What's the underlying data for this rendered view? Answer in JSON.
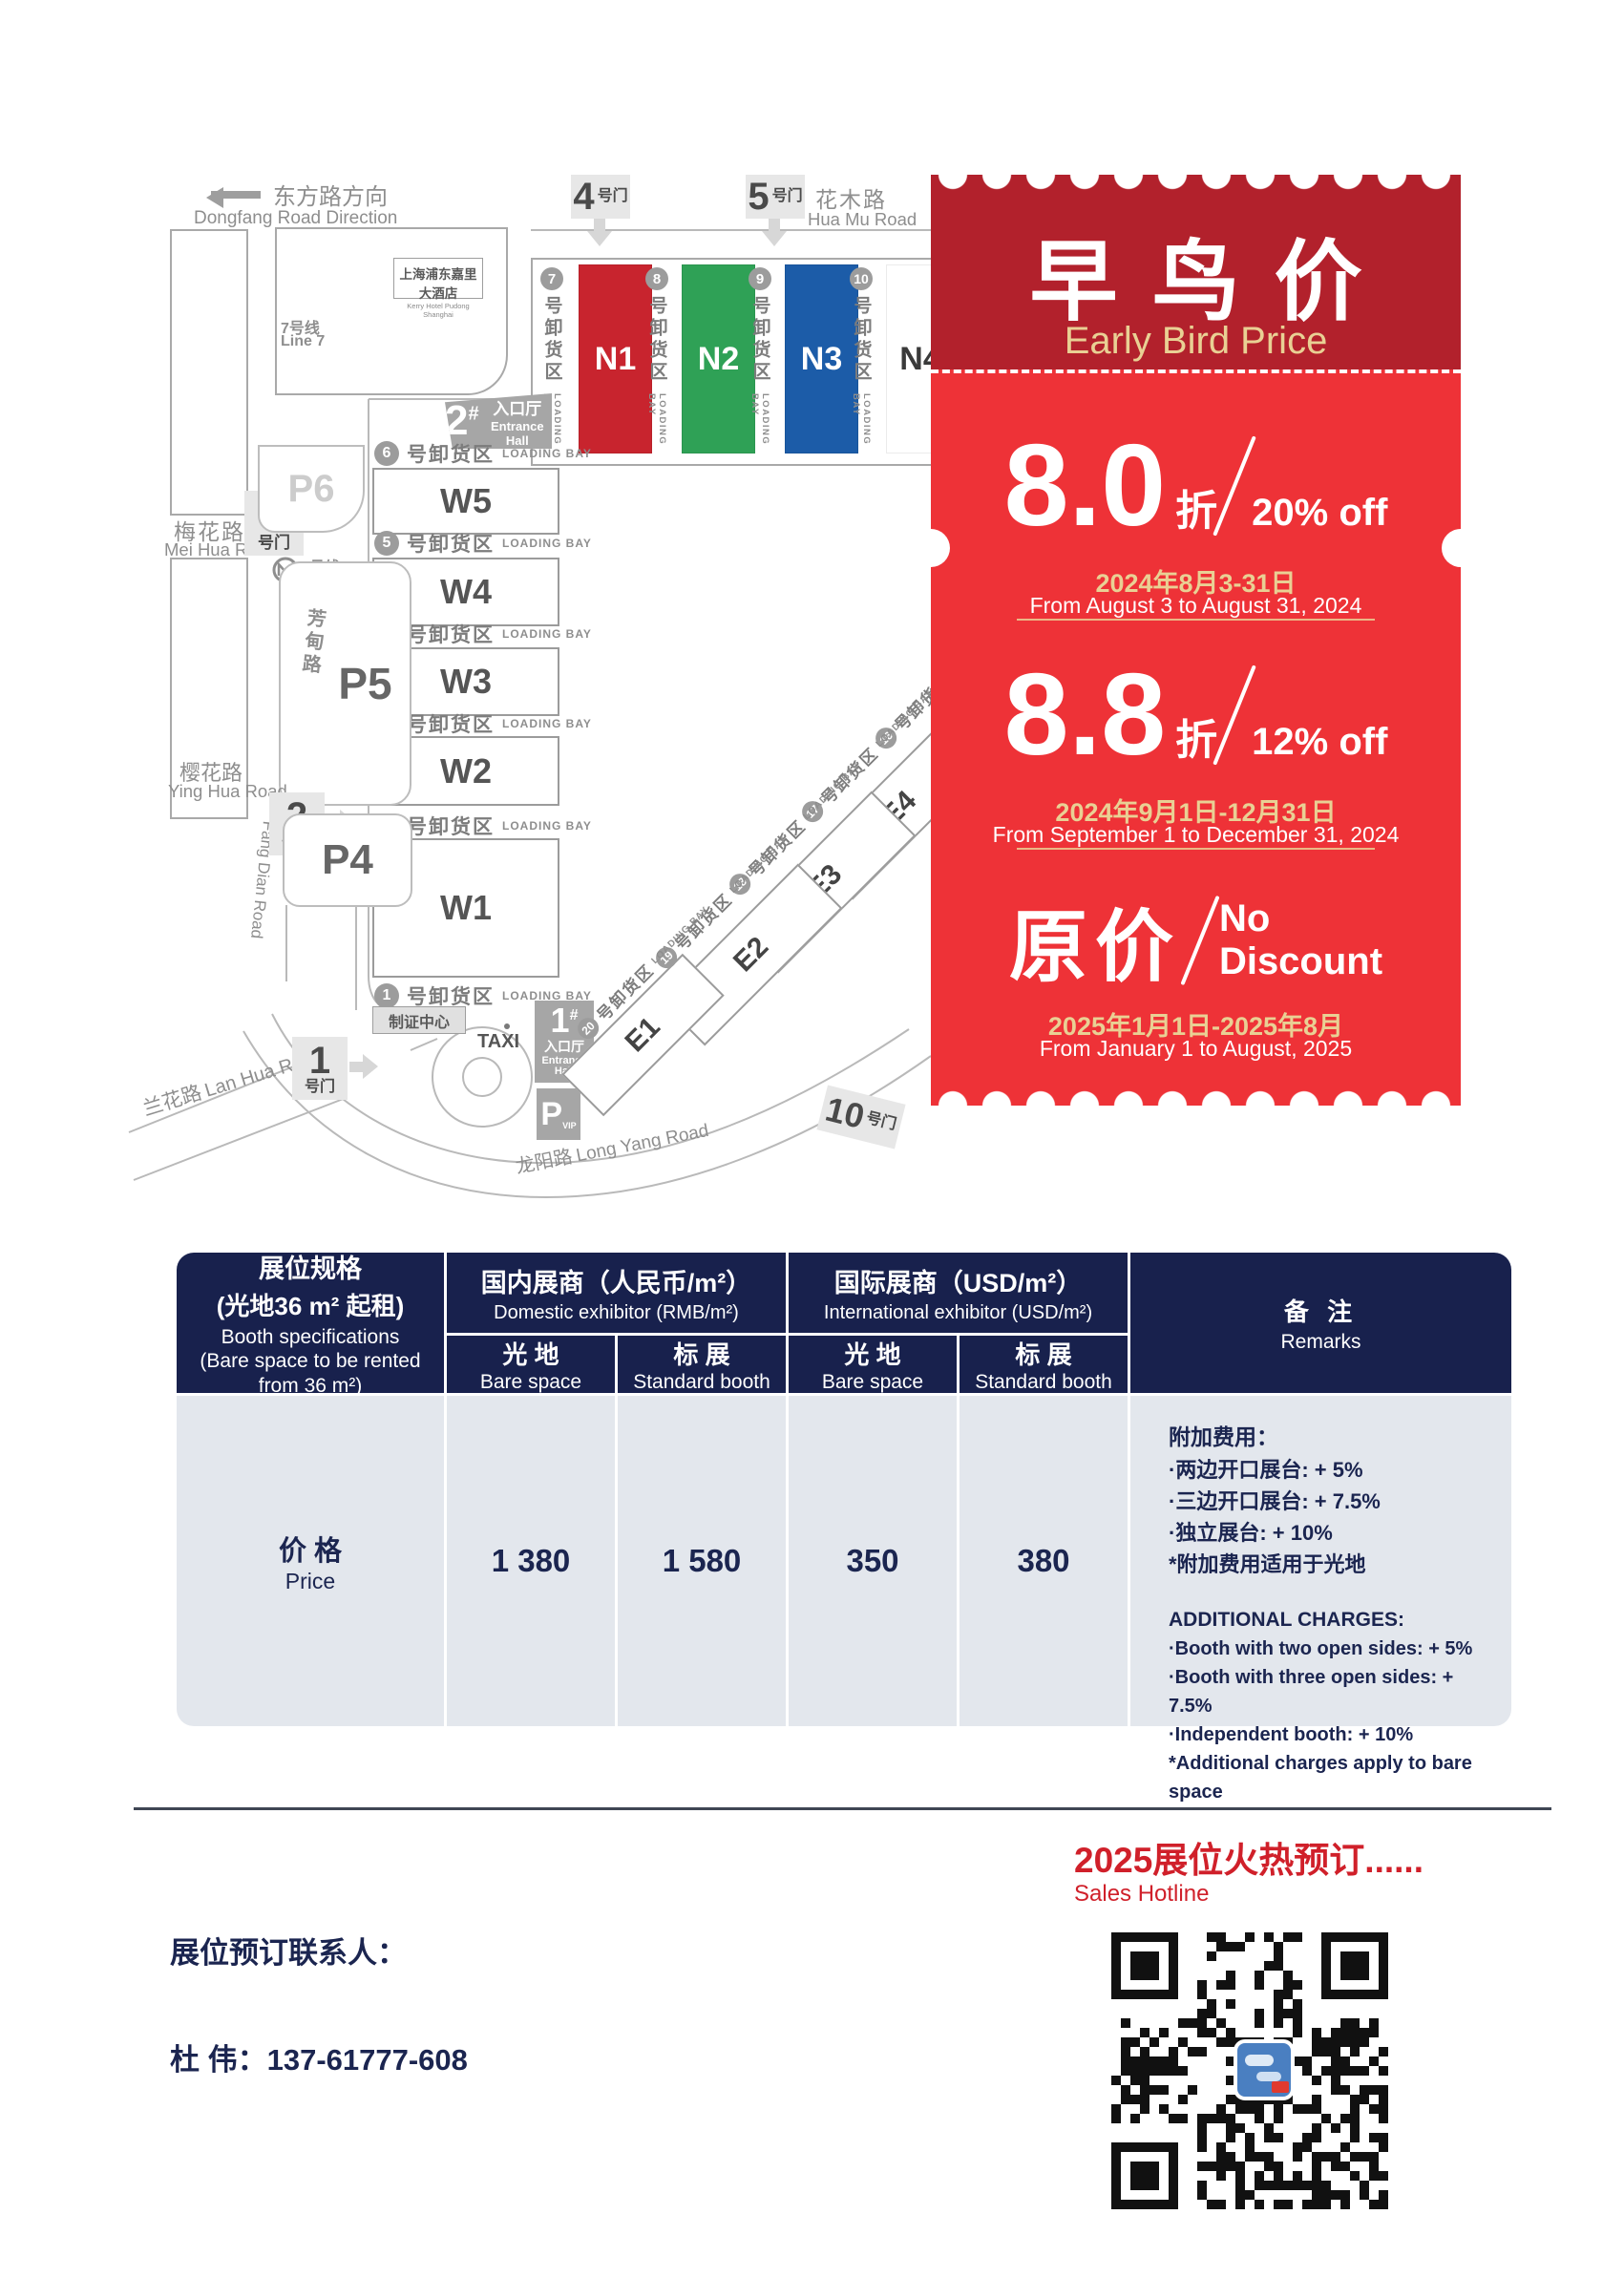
{
  "map": {
    "direction_zh": "东方路方向",
    "direction_en": "Dongfang Road Direction",
    "gate_suffix": "号门",
    "gate4_num": "4",
    "gate5_num": "5",
    "gate3_num": "3",
    "gate2_num": "2",
    "gate1_num": "1",
    "gate10_num": "10",
    "huamu_zh": "花木路",
    "huamu_en": "Hua Mu Road",
    "meihua_zh": "梅花路",
    "meihua_en": "Mei Hua Road",
    "yinghua_zh": "樱花路",
    "yinghua_en": "Ying Hua Road",
    "fangdian_zh": "芳甸路",
    "fangdian_en": "Fang Dian Road",
    "lanhua_zh": "兰花路",
    "lanhua_en": "Lan Hua Road",
    "longyang_zh": "龙阳路",
    "longyang_en": "Long Yang Road",
    "hotel_zh": "上海浦东嘉里大酒店",
    "hotel_en": "Kerry Hotel Pudong Shanghai",
    "metro_zh": "7号线",
    "metro_en": "Line 7",
    "p6": "P6",
    "p5": "P5",
    "p4": "P4",
    "pvip": "P",
    "pvip_sub": "VIP",
    "ent2_num": "2",
    "ent1_num": "1",
    "ent_hash": "#",
    "ent_zh": "入口厅",
    "ent_en": "Entrance Hall",
    "zhizheng": "制证中心",
    "taxi": "TAXI",
    "bay_zh": "号卸货区",
    "bay_en": "LOADING BAY",
    "bays_n": [
      "7",
      "8",
      "9",
      "10"
    ],
    "halls_n": [
      {
        "label": "N1",
        "color": "#c8242e",
        "text": "#ffffff"
      },
      {
        "label": "N2",
        "color": "#2fa156",
        "text": "#ffffff"
      },
      {
        "label": "N3",
        "color": "#1c5ca8",
        "text": "#ffffff"
      },
      {
        "label": "N4",
        "color": "#ffffff",
        "text": "#3a3a3a"
      }
    ],
    "halls_w": [
      "W5",
      "W4",
      "W3",
      "W2",
      "W1"
    ],
    "bays_w": [
      "6",
      "5",
      "4",
      "3",
      "2",
      "1"
    ],
    "halls_e": [
      "E4",
      "E3",
      "E2",
      "E1"
    ],
    "bays_e": [
      "16",
      "17",
      "18",
      "19",
      "20"
    ]
  },
  "promo": {
    "title_zh": "早鸟价",
    "title_en": "Early Bird Price",
    "tier1_rate": "8.0",
    "tier1_zhe": "折",
    "tier1_off": "20% off",
    "tier1_date_zh": "2024年8月3-31日",
    "tier1_date_en": "From August 3 to August 31, 2024",
    "tier2_rate": "8.8",
    "tier2_zhe": "折",
    "tier2_off": "12% off",
    "tier2_date_zh": "2024年9月1日-12月31日",
    "tier2_date_en": "From September 1 to December 31, 2024",
    "tier3_label": "原价",
    "tier3_off1": "No",
    "tier3_off2": "Discount",
    "tier3_date_zh": "2025年1月1日-2025年8月",
    "tier3_date_en": "From January 1 to August, 2025"
  },
  "table": {
    "spec_zh1": "展位规格",
    "spec_zh2": "(光地36 m² 起租)",
    "spec_en1": "Booth specifications",
    "spec_en2": "(Bare space to be rented from 36 m²)",
    "grp_domestic_zh": "国内展商（人民币/m²）",
    "grp_domestic_en": "Domestic exhibitor (RMB/m²)",
    "grp_intl_zh": "国际展商（USD/m²）",
    "grp_intl_en": "International exhibitor (USD/m²)",
    "sub_bare_zh": "光 地",
    "sub_bare_en": "Bare space",
    "sub_std_zh": "标 展",
    "sub_std_en": "Standard booth",
    "remarks_zh": "备 注",
    "remarks_en": "Remarks",
    "row_price_zh": "价 格",
    "row_price_en": "Price",
    "values": [
      "1 380",
      "1 580",
      "350",
      "380"
    ],
    "remarks_zh_title": "附加费用：",
    "remarks_zh_items": [
      "·两边开口展台: + 5%",
      "·三边开口展台: + 7.5%",
      "·独立展台: + 10%",
      "*附加费用适用于光地"
    ],
    "remarks_en_title": "ADDITIONAL CHARGES:",
    "remarks_en_items": [
      "·Booth with two open sides: + 5%",
      "·Booth with three open sides: + 7.5%",
      "·Independent booth: + 10%",
      "*Additional charges apply to bare space"
    ]
  },
  "footer": {
    "hotline_zh": "2025展位火热预订......",
    "hotline_en": "Sales Hotline",
    "contact_label": "展位预订联系人：",
    "contact_person": "杜  伟：137-61777-608"
  }
}
